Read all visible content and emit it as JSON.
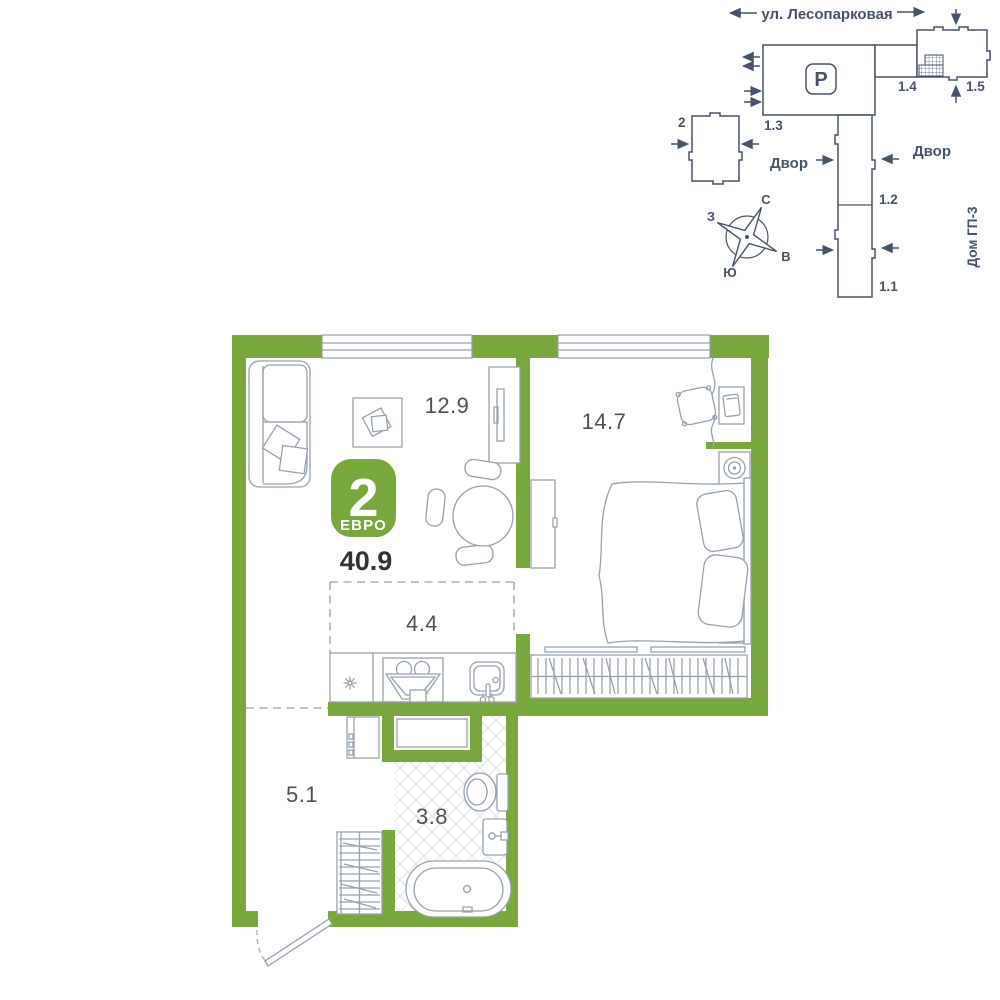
{
  "colors": {
    "wall_green": "#78A83D",
    "site_line": "#47536A",
    "furniture_line": "#96A1AD",
    "area_label": "#4C5257",
    "total_label": "#2F343A",
    "tile_line": "#DEE3E8",
    "dash_line": "#A6AFB8",
    "badge_text": "#FFFFFF"
  },
  "site_plan": {
    "street_label": "ул. Лесопарковая",
    "parking_label": "P",
    "buildings": {
      "b2": "2",
      "b1_3": "1.3",
      "b1_4": "1.4",
      "b1_5": "1.5",
      "b1_2": "1.2",
      "b1_1": "1.1"
    },
    "courtyard_left": "Двор",
    "courtyard_right": "Двор",
    "house_label": "Дом ГП-3",
    "compass": {
      "north": "С",
      "south": "Ю",
      "west": "З",
      "east": "В"
    }
  },
  "floor_plan": {
    "badge": {
      "room_count": "2",
      "type_label": "ЕВРО"
    },
    "total_area": "40.9",
    "rooms": [
      {
        "name": "living-room",
        "area": "12.9"
      },
      {
        "name": "bedroom",
        "area": "14.7"
      },
      {
        "name": "kitchen",
        "area": "4.4"
      },
      {
        "name": "hallway",
        "area": "5.1"
      },
      {
        "name": "bathroom",
        "area": "3.8"
      }
    ]
  }
}
